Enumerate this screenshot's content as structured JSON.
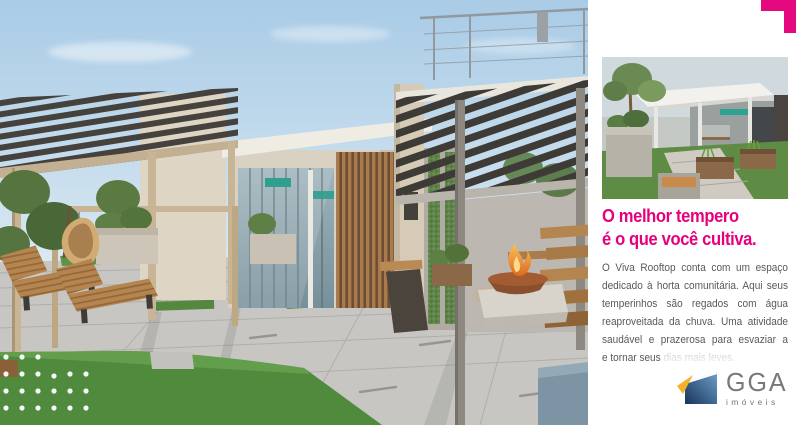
{
  "panel": {
    "headline": {
      "line1": "O melhor tempero",
      "line2": "é o que você cultiva.",
      "color": "#e6007e"
    },
    "body_lines": [
      "O Viva Rooftop conta com um espaço",
      "dedicado à horta comunitária. Aqui seus",
      "temperinhos são regados com água",
      "reaproveitada da chuva. Uma atividade",
      "saudável e prazerosa para esvaziar a mente",
      "e tornar seus dias mais leves."
    ],
    "body_color": "#58585a",
    "background": "#ffffff",
    "corner_accent_color": "#e5097f"
  },
  "logo": {
    "title": "GGA",
    "subtitle": "imóveis",
    "text_color": "#77787b",
    "icon_colors": {
      "navy": "#16345c",
      "blue": "#6fa0c8",
      "yellow": "#f3b229"
    }
  },
  "scene_palette": {
    "sky_top": "#a9cbe6",
    "sky_bottom": "#ddeaf3",
    "grass": "#4f8a3d",
    "pavers": "#c7c6c2",
    "wood": "#b5854f",
    "pergola_slats": "#3e3b37",
    "pergola_frame_tan": "#c8b596",
    "wall_cream": "#d9d1c2",
    "wall_gray": "#bcb8b1",
    "green_wall": "#5f8449",
    "sign_teal": "#2fa08f",
    "flame_orange": "#ef8f2e",
    "blue_bench": "#7d94a5"
  }
}
